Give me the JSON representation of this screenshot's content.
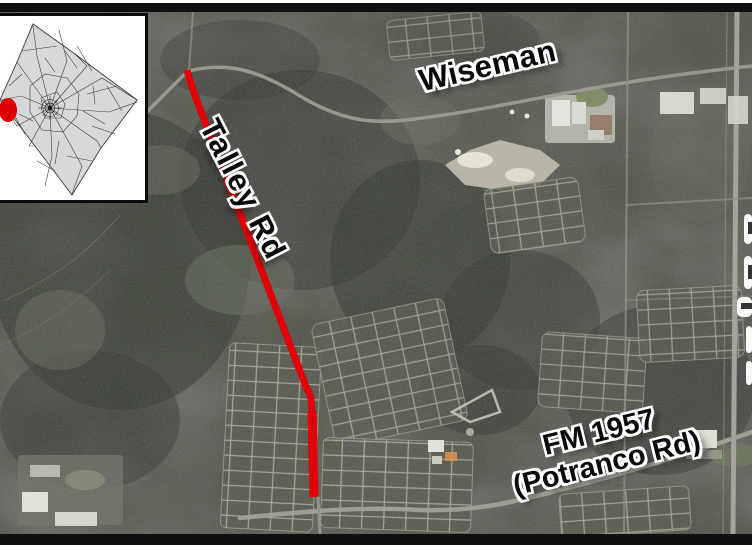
{
  "figure": {
    "kind": "aerial-route-map",
    "frame_color": "#101010"
  },
  "map": {
    "road_labels": [
      {
        "id": "wiseman",
        "text": "Wiseman"
      },
      {
        "id": "talley",
        "text": "Talley Rd"
      },
      {
        "id": "fm1957",
        "line1": "FM 1957",
        "line2": "(Potranco Rd)"
      }
    ],
    "highlight_route": {
      "name": "Talley Rd",
      "color": "#e10008"
    }
  },
  "inset": {
    "name": "county-locator-map",
    "marker_color": "#dc0000",
    "land_color": "#d8d8d8"
  }
}
